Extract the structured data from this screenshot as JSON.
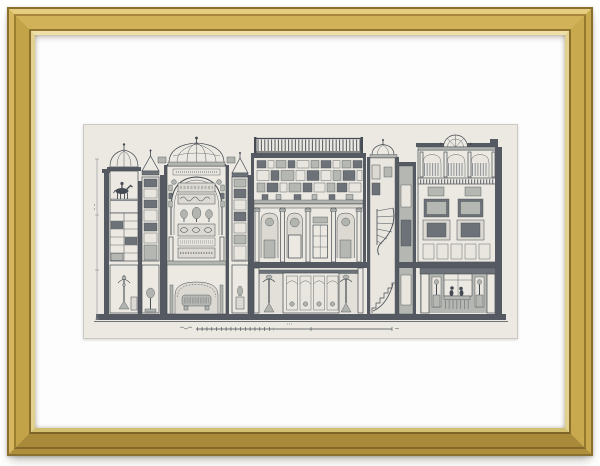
{
  "artwork": {
    "type": "antique engraving print, framed",
    "description": "Architectural cross-section engraving of a museum interior: domed pavilions, a railed roof skylight, gallery walls densely hung with framed pictures, a colonnade with mask niches, glazed bookcases with busts, urns and candelabra, a sarcophagus in an arched crypt, a spiral staircase, and a right-hand room with figures at a draped table; a drawn scale bar runs beneath the building",
    "frame_style": "gold wood frame",
    "mount": "white mat"
  },
  "theme": {
    "bg": "#ffffff",
    "mat": "#fdfdfd",
    "frame-gold": "#c8a94e",
    "frame-gold-deep": "#97782c",
    "frame-edge": "#8a7030",
    "frame-lip": "#eee0a8",
    "paper": "#ebe9e2",
    "paper-edge": "#cbc9c1",
    "ink": "#464b53",
    "poche": "#555962",
    "mid": "#b2b5af",
    "shade": "#dbd9d1",
    "pic-dark": "#6d7278",
    "pic-mid": "#b4b7b2",
    "pic-light": "#e8e6de",
    "faint": "#8e9299"
  }
}
